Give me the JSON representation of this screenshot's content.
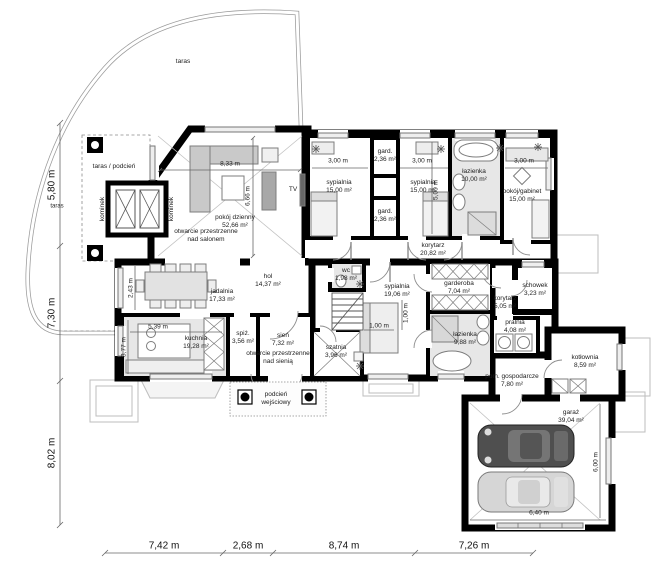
{
  "plan": {
    "rooms": [
      {
        "name": "pokój dzienny",
        "area": "52,66 m²"
      },
      {
        "name": "sypialnia",
        "area": "15,00 m²"
      },
      {
        "name": "gard.",
        "area": "2,36 m²"
      },
      {
        "name": "gard.",
        "area": "2,36 m²"
      },
      {
        "name": "sypialnia",
        "area": "15,00 m²"
      },
      {
        "name": "łazienka",
        "area": "10,00 m²"
      },
      {
        "name": "pokój/gabinet",
        "area": "15,00 m²"
      },
      {
        "name": "korytarz",
        "area": "20,82 m²"
      },
      {
        "name": "jadalnia",
        "area": "17,33 m²"
      },
      {
        "name": "hol",
        "area": "14,37 m²"
      },
      {
        "name": "wc",
        "area": "1,98 m²"
      },
      {
        "name": "sypialnia",
        "area": "19,06 m²"
      },
      {
        "name": "garderoba",
        "area": "7,04 m²"
      },
      {
        "name": "korytarz",
        "area": "5,05 m²"
      },
      {
        "name": "schowek",
        "area": "3,23 m²"
      },
      {
        "name": "pralnia",
        "area": "4,08 m²"
      },
      {
        "name": "kuchnia",
        "area": "19,28 m²"
      },
      {
        "name": "spiż.",
        "area": "3,56 m²"
      },
      {
        "name": "sień",
        "area": "7,32 m²"
      },
      {
        "name": "szatnia",
        "area": "3,96 m²"
      },
      {
        "name": "łazienka",
        "area": "9,88 m²"
      },
      {
        "name": "kotłownia",
        "area": "8,59 m²"
      },
      {
        "name": "pom. gospodarcze",
        "area": "7,80 m²"
      },
      {
        "name": "garaż",
        "area": "39,04 m²"
      }
    ],
    "labels": {
      "taras_top": "taras",
      "taras_left": "taras",
      "taras_podcien": "taras / podcień",
      "kominek_left": "kominek",
      "kominek_right": "kominek",
      "tv": "TV",
      "open_salon_1": "otwarcie przestrzenne",
      "open_salon_2": "nad salonem",
      "open_sien_1": "otwarcie przestrzenne",
      "open_sien_2": "nad sienią",
      "podcien_1": "podcień",
      "podcien_2": "wejściowy"
    },
    "dimensions": {
      "bottom": [
        "7,42 m",
        "2,68 m",
        "8,74 m",
        "7,26 m"
      ],
      "left": [
        "5,80 m",
        "7,30 m",
        "8,02 m"
      ],
      "interior": {
        "living_w": "8,33 m",
        "living_h": "6,66 m",
        "syp1_w": "3,00 m",
        "syp2_w": "3,00 m",
        "gabinet_w": "3,00 m",
        "syp2_h": "5,00 m",
        "jadalnia_h": "2,43 m",
        "kuchnia_w": "5,39 m",
        "kuchnia_h": "3,77 m",
        "bed_w": "1,00 m",
        "bed_h": "1,00 m",
        "garaz_w": "6,40 m",
        "garaz_h": "6,00 m"
      }
    },
    "colors": {
      "wall": "#000000",
      "floor_grey": "#e7e7e7",
      "car_dark": "#4f4f4f",
      "car_light": "#d6d6d6"
    }
  }
}
